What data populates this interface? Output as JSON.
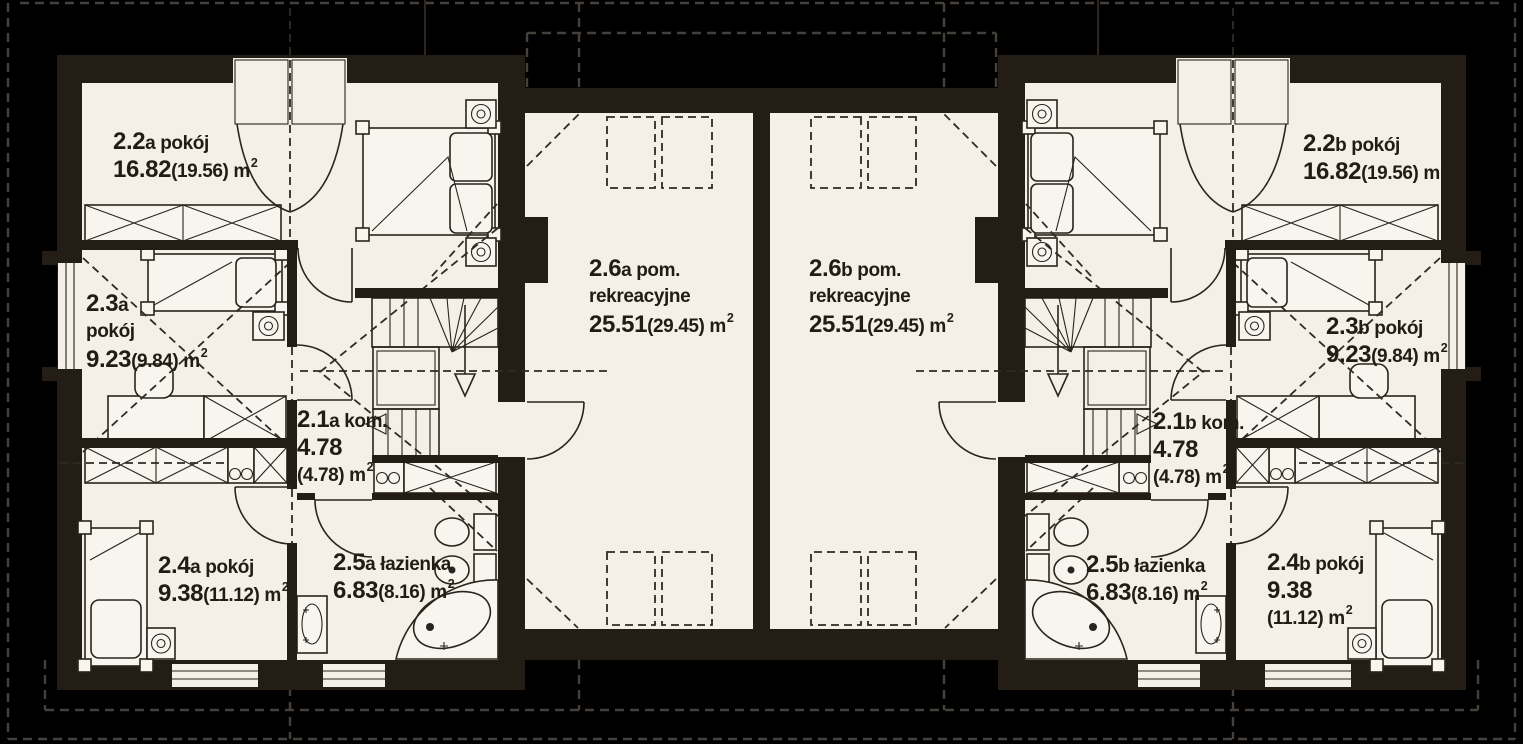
{
  "plan": {
    "floor_name": "attic storey duplex floor plan",
    "units": [
      "a",
      "b"
    ]
  },
  "colors": {
    "page": "#000000",
    "building": "#231d16",
    "floor": "#f4efe7",
    "fixture": "#f8f4ee",
    "line": "#29241d",
    "guide": "#2f2a24",
    "background_dash": "#46403a",
    "text": "#221c15"
  },
  "rooms": [
    {
      "id": "2-2a",
      "x": 113,
      "y": 128,
      "lines": [
        [
          {
            "t": "2.2",
            "k": "big"
          },
          {
            "t": "a pokój",
            "k": "med"
          }
        ],
        [
          {
            "t": "16.82",
            "k": "big"
          },
          {
            "t": "(19.56) m",
            "k": "med"
          },
          {
            "t": "2",
            "k": "sup"
          }
        ]
      ]
    },
    {
      "id": "2-3a",
      "x": 86,
      "y": 290,
      "lines": [
        [
          {
            "t": "2.3",
            "k": "big"
          },
          {
            "t": "a",
            "k": "med"
          }
        ],
        [
          {
            "t": "pokój",
            "k": "med"
          }
        ],
        [
          {
            "t": "9.23",
            "k": "big"
          },
          {
            "t": "(9.84) m",
            "k": "med"
          },
          {
            "t": "2",
            "k": "sup"
          }
        ]
      ]
    },
    {
      "id": "2-1a",
      "x": 297,
      "y": 406,
      "lines": [
        [
          {
            "t": "2.1",
            "k": "big"
          },
          {
            "t": "a kom.",
            "k": "med"
          }
        ],
        [
          {
            "t": "4.78",
            "k": "big"
          }
        ],
        [
          {
            "t": "(4.78) m",
            "k": "med"
          },
          {
            "t": "2",
            "k": "sup"
          }
        ]
      ]
    },
    {
      "id": "2-4a",
      "x": 158,
      "y": 552,
      "lines": [
        [
          {
            "t": "2.4",
            "k": "big"
          },
          {
            "t": "a pokój",
            "k": "med"
          }
        ],
        [
          {
            "t": "9.38",
            "k": "big"
          },
          {
            "t": "(11.12) m",
            "k": "med"
          },
          {
            "t": "2",
            "k": "sup"
          }
        ]
      ]
    },
    {
      "id": "2-5a",
      "x": 333,
      "y": 549,
      "lines": [
        [
          {
            "t": "2.5",
            "k": "big"
          },
          {
            "t": "a łazienka",
            "k": "med"
          }
        ],
        [
          {
            "t": "6.83",
            "k": "big"
          },
          {
            "t": "(8.16) m",
            "k": "med"
          },
          {
            "t": "2",
            "k": "sup"
          }
        ]
      ]
    },
    {
      "id": "2-6a",
      "x": 589,
      "y": 255,
      "lines": [
        [
          {
            "t": "2.6",
            "k": "big"
          },
          {
            "t": "a pom.",
            "k": "med"
          }
        ],
        [
          {
            "t": "rekreacyjne",
            "k": "med"
          }
        ],
        [
          {
            "t": "25.51",
            "k": "big"
          },
          {
            "t": "(29.45) m",
            "k": "med"
          },
          {
            "t": "2",
            "k": "sup"
          }
        ]
      ]
    },
    {
      "id": "2-6b",
      "x": 809,
      "y": 255,
      "lines": [
        [
          {
            "t": "2.6",
            "k": "big"
          },
          {
            "t": "b pom.",
            "k": "med"
          }
        ],
        [
          {
            "t": "rekreacyjne",
            "k": "med"
          }
        ],
        [
          {
            "t": "25.51",
            "k": "big"
          },
          {
            "t": "(29.45) m",
            "k": "med"
          },
          {
            "t": "2",
            "k": "sup"
          }
        ]
      ]
    },
    {
      "id": "2-2b",
      "x": 1303,
      "y": 130,
      "lines": [
        [
          {
            "t": "2.2",
            "k": "big"
          },
          {
            "t": "b pokój",
            "k": "med"
          }
        ],
        [
          {
            "t": "16.82",
            "k": "big"
          },
          {
            "t": "(19.56) m",
            "k": "med"
          },
          {
            "t": "2",
            "k": "sup"
          }
        ]
      ]
    },
    {
      "id": "2-3b",
      "x": 1326,
      "y": 313,
      "lines": [
        [
          {
            "t": "2.3",
            "k": "big"
          },
          {
            "t": "b pokój",
            "k": "med"
          }
        ],
        [
          {
            "t": "9.23",
            "k": "big"
          },
          {
            "t": "(9.84) m",
            "k": "med"
          },
          {
            "t": "2",
            "k": "sup"
          }
        ]
      ]
    },
    {
      "id": "2-1b",
      "x": 1153,
      "y": 408,
      "lines": [
        [
          {
            "t": "2.1",
            "k": "big"
          },
          {
            "t": "b kom.",
            "k": "med"
          }
        ],
        [
          {
            "t": "4.78",
            "k": "big"
          }
        ],
        [
          {
            "t": "(4.78) m",
            "k": "med"
          },
          {
            "t": "2",
            "k": "sup"
          }
        ]
      ]
    },
    {
      "id": "2-5b",
      "x": 1086,
      "y": 551,
      "lines": [
        [
          {
            "t": "2.5",
            "k": "big"
          },
          {
            "t": "b łazienka",
            "k": "med"
          }
        ],
        [
          {
            "t": "6.83",
            "k": "big"
          },
          {
            "t": "(8.16) m",
            "k": "med"
          },
          {
            "t": "2",
            "k": "sup"
          }
        ]
      ]
    },
    {
      "id": "2-4b",
      "x": 1267,
      "y": 549,
      "lines": [
        [
          {
            "t": "2.4",
            "k": "big"
          },
          {
            "t": "b pokój",
            "k": "med"
          }
        ],
        [
          {
            "t": "9.38",
            "k": "big"
          }
        ],
        [
          {
            "t": "(11.12) m",
            "k": "med"
          },
          {
            "t": "2",
            "k": "sup"
          }
        ]
      ]
    }
  ]
}
